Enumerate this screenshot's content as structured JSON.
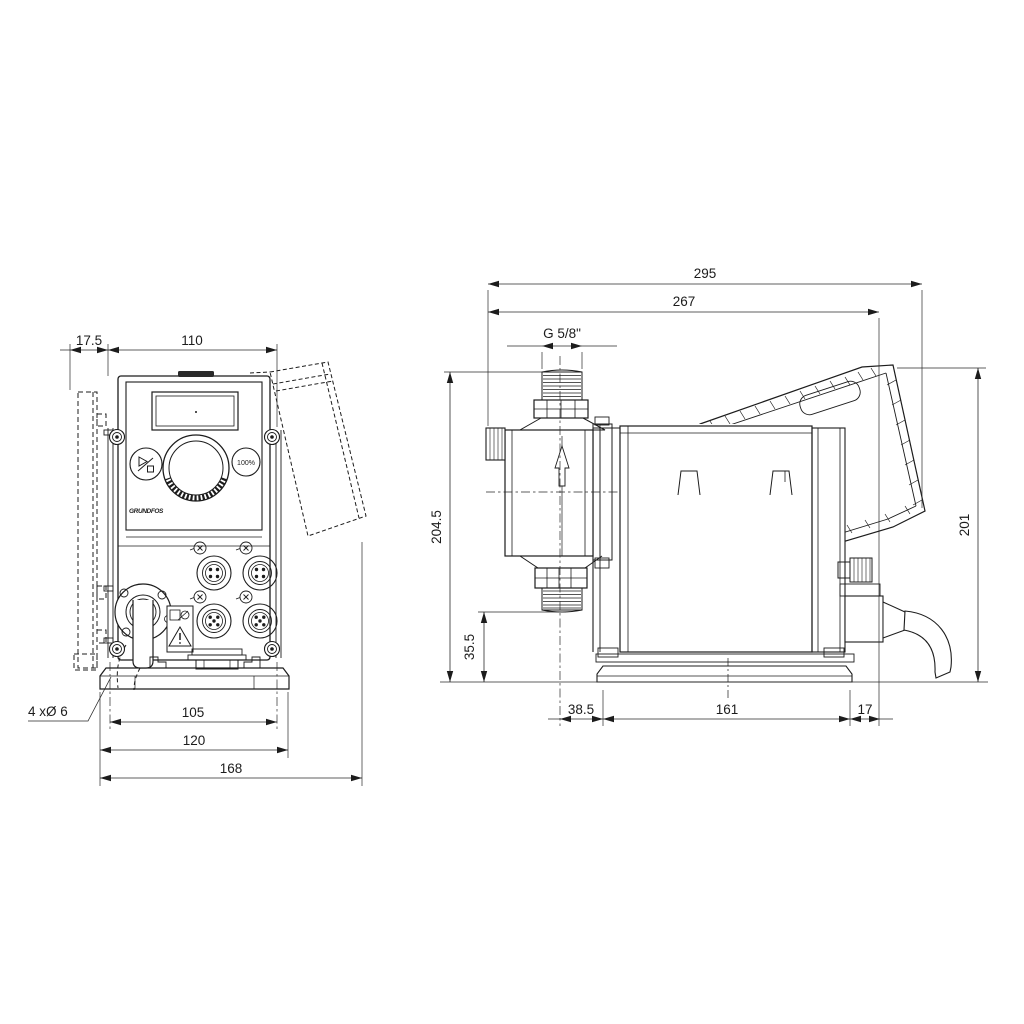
{
  "front_view": {
    "dim_bracket_offset": "17.5",
    "dim_body_width": "110",
    "dim_hole_spacing": "105",
    "dim_base_width": "120",
    "dim_overall_width": "168",
    "mounting_holes_label": "4 xØ 6",
    "full_capacity_button": "100%",
    "logo": "GRUNDFOS"
  },
  "side_view": {
    "dim_overall_depth": "295",
    "dim_housing_depth": "267",
    "thread_label": "G 5/8\"",
    "dim_overall_height": "204.5",
    "dim_connection_height": "35.5",
    "dim_rear_height": "201",
    "dim_front_offset": "38.5",
    "dim_base_length": "161",
    "dim_rear_offset": "17"
  }
}
